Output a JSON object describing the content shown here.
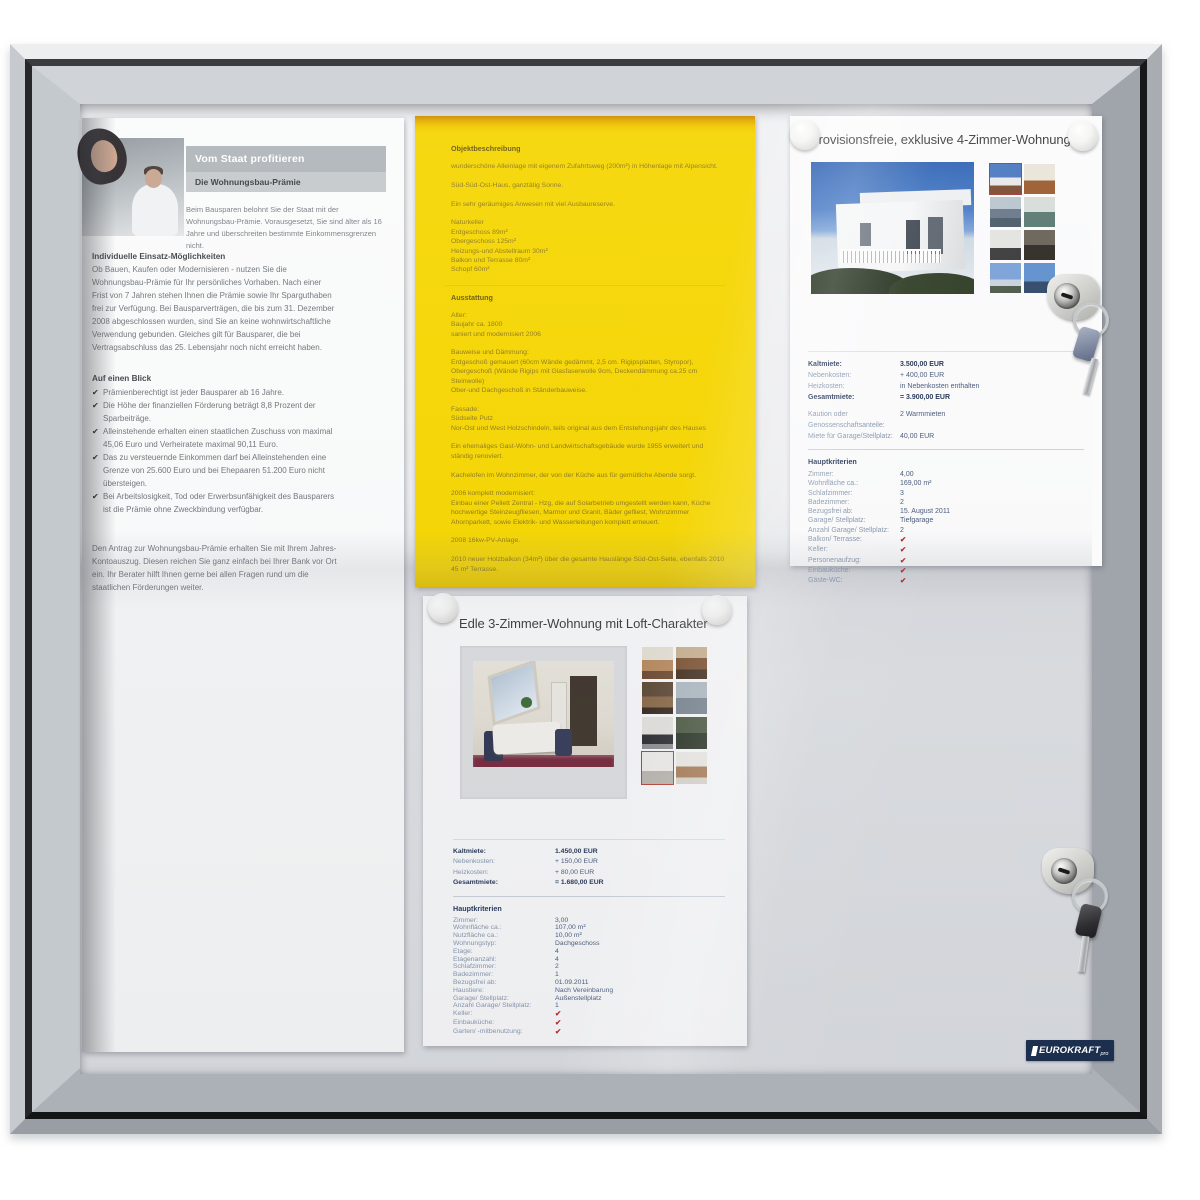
{
  "board": {
    "logo": {
      "text": "EUROKRAFT",
      "suffix": "pro"
    }
  },
  "flyer_staat": {
    "title": "Vom Staat profitieren",
    "subtitle": "Die Wohnungsbau-Prämie",
    "intro": "Beim Bausparen belohnt Sie der Staat mit der Wohnungsbau-Prämie. Vorausgesetzt, Sie sind älter als 16 Jahre und überschreiten bestimmte Einkommensgrenzen nicht.",
    "section1_title": "Individuelle Einsatz-Möglichkeiten",
    "section1_text": "Ob Bauen, Kaufen oder Modernisieren - nutzen Sie die Wohnungsbau-Prämie für Ihr persönliches Vorhaben. Nach einer Frist von 7 Jahren stehen Ihnen die Prämie sowie Ihr Sparguthaben frei zur Verfügung. Bei Bausparverträgen, die bis zum 31. Dezember 2008 abgeschlossen wurden, sind Sie an keine wohnwirtschaftliche Verwendung gebunden. Gleiches gilt für Bausparer, die bei Vertragsabschluss das 25. Lebensjahr noch nicht erreicht haben.",
    "section2_title": "Auf einen Blick",
    "bullets": [
      "Prämienberechtigt ist jeder Bausparer ab 16 Jahre.",
      "Die Höhe der finanziellen Förderung beträgt 8,8 Prozent der Sparbeiträge.",
      "Alleinstehende erhalten einen staatlichen Zuschuss von maximal 45,06 Euro und Verheiratete maximal 90,11 Euro.",
      "Das zu versteuernde Einkommen darf bei Alleinstehenden eine Grenze von 25.600 Euro und bei Ehepaaren 51.200 Euro nicht übersteigen.",
      "Bei Arbeitslosigkeit, Tod oder Erwerbsunfähigkeit des Bausparers ist die Prämie ohne Zweckbindung verfügbar."
    ],
    "outro": "Den Antrag zur Wohnungsbau-Prämie erhalten Sie mit Ihrem Jahres-Kontoauszug. Diesen reichen Sie ganz einfach bei Ihrer Bank vor Ort ein. Ihr Berater hilft Ihnen gerne bei allen Fragen rund um die staatlichen Förderungen weiter."
  },
  "flyer_objekt": {
    "heading_description": "Objektbeschreibung",
    "desc_lines": [
      "wunderschöne Alleinlage mit eigenem Zufahrtsweg (200m²)  in Höhenlage mit Alpensicht.",
      "",
      "Süd-Süd-Ost-Haus, ganztätig Sonne.",
      "",
      "Ein sehr geräumiges Anwesen mit viel Ausbaureserve.",
      "",
      "Naturkeller",
      "Erdgeschoss 89m²",
      "Obergeschoss 125m²",
      "Heizungs-und Abstellraum 30m²",
      "Balkon und Terrasse 80m²",
      "Schopf 60m²"
    ],
    "heading_features": "Ausstattung",
    "feature_lines": [
      "Alter:",
      "Baujahr ca. 1800",
      "saniert und modernisiert 2006",
      "",
      "Bauweise und Dämmung:",
      "Erdgeschoß gemauert (60cm Wände gedämmt, 2,5 cm. Rigipsplatten, Styropor),",
      "Obergeschoß (Wände Rigips mit Glasfaserwolle 9cm,  Deckendämmung ca.25 cm Steinwolle)",
      "Ober-und Dachgeschoß in Ständerbauweise.",
      "",
      "Fassade:",
      "Südseite Putz",
      "Nor-Ost und West Holzschindeln, teils original aus dem Entstehungsjahr des Hauses",
      "",
      "Ein ehemaliges Gast-Wohn- und Landwirtschaftsgebäude wurde 1955 erweitert und ständig renoviert.",
      "",
      "Kachelofen im Wohnzimmer, der von der Küche aus für gemütliche Abende sorgt.",
      "",
      "2006 komplett modernisiert:",
      "Einbau einer Pellett Zentral - Hzg, die auf Solarbetrieb umgestellt werden kann, Küche hochwertige Steinzeugfliesen, Marmor und Granit, Bäder gefliest, Wohnzimmer Ahornparkett, sowie Elektrik- und Wasserleitungen komplett erneuert.",
      "",
      "2008 16kw-PV-Anlage.",
      "",
      "2010 neuer Holzbalkon (34m²) über die gesamte Hauslänge Süd-Ost-Seite, ebenfalls 2010 45 m² Terrasse."
    ]
  },
  "listing_4zimmer": {
    "title": "Provisionsfreie, exklusive 4-Zimmer-Wohnung",
    "rent": [
      {
        "label": "Kaltmiete:",
        "value": "3.500,00 EUR",
        "bold": true
      },
      {
        "label": "Nebenkosten:",
        "value": "+ 400,00 EUR"
      },
      {
        "label": "Heizkosten:",
        "value": "in Nebenkosten enthalten"
      },
      {
        "label": "Gesamtmiete:",
        "value": "= 3.900,00 EUR",
        "bold": true
      }
    ],
    "deposit": [
      {
        "label": "Kaution oder Genossenschaftsanteile:",
        "value": "2 Warmmieten"
      },
      {
        "label": "Miete für Garage/Stellplatz:",
        "value": "40,00 EUR"
      }
    ],
    "criteria_title": "Hauptkriterien",
    "criteria": [
      {
        "label": "Zimmer:",
        "value": "4,00"
      },
      {
        "label": "Wohnfläche ca.:",
        "value": "169,00 m²"
      },
      {
        "label": "Schlafzimmer:",
        "value": "3"
      },
      {
        "label": "Badezimmer:",
        "value": "2"
      },
      {
        "label": "Bezugsfrei ab:",
        "value": "15. August 2011"
      },
      {
        "label": "Garage/ Stellplatz:",
        "value": "Tiefgarage"
      },
      {
        "label": "Anzahl Garage/ Stellplatz:",
        "value": "2"
      },
      {
        "label": "Balkon/ Terrasse:",
        "check": true
      },
      {
        "label": "Keller:",
        "check": true
      },
      {
        "label": "Personenaufzug:",
        "check": true
      },
      {
        "label": "Einbauküche:",
        "check": true
      },
      {
        "label": "Gäste-WC:",
        "check": true
      }
    ]
  },
  "listing_3zimmer": {
    "title": "Edle 3-Zimmer-Wohnung mit Loft-Charakter",
    "rent": [
      {
        "label": "Kaltmiete:",
        "value": "1.450,00 EUR",
        "bold": true
      },
      {
        "label": "Nebenkosten:",
        "value": "+ 150,00 EUR"
      },
      {
        "label": "Heizkosten:",
        "value": "+ 80,00 EUR"
      },
      {
        "label": "Gesamtmiete:",
        "value": "= 1.680,00 EUR",
        "bold": true
      }
    ],
    "criteria_title": "Hauptkriterien",
    "criteria": [
      {
        "label": "Zimmer:",
        "value": "3,00"
      },
      {
        "label": "Wohnfläche ca.:",
        "value": "107,00 m²"
      },
      {
        "label": "Nutzfläche ca.:",
        "value": "10,00 m²"
      },
      {
        "label": "Wohnungstyp:",
        "value": "Dachgeschoss"
      },
      {
        "label": "Etage:",
        "value": "4"
      },
      {
        "label": "Etagenanzahl:",
        "value": "4"
      },
      {
        "label": "Schlafzimmer:",
        "value": "2"
      },
      {
        "label": "Badezimmer:",
        "value": "1"
      },
      {
        "label": "Bezugsfrei ab:",
        "value": "01.09.2011"
      },
      {
        "label": "Haustiere:",
        "value": "Nach Vereinbarung"
      },
      {
        "label": "Garage/ Stellplatz:",
        "value": "Außenstellplatz"
      },
      {
        "label": "Anzahl Garage/ Stellplatz:",
        "value": "1"
      },
      {
        "label": "Keller:",
        "check": true
      },
      {
        "label": "Einbauküche:",
        "check": true
      },
      {
        "label": "Garten/ -mitbenutzung:",
        "check": true
      }
    ]
  },
  "colors": {
    "frame_silver": "#c6cacd",
    "yellow_paper": "#f6d704",
    "yellow_text": "#917c1e",
    "listing_label": "#8494ac",
    "listing_value": "#46587a",
    "check_red": "#b5252b",
    "logo_navy": "#1d2f4e"
  }
}
